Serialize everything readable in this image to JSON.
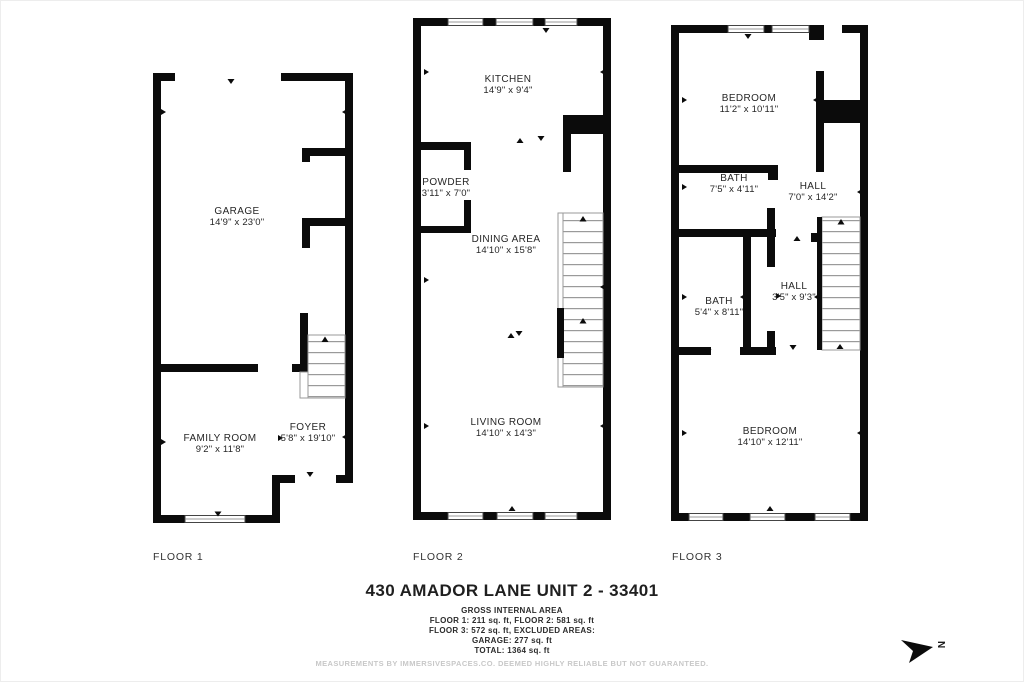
{
  "building": {
    "title": "430 AMADOR LANE UNIT 2 - 33401"
  },
  "area_summary": {
    "heading": "GROSS INTERNAL AREA",
    "lines": [
      "FLOOR 1: 211 sq. ft, FLOOR 2: 581 sq. ft",
      "FLOOR 3: 572 sq. ft, EXCLUDED AREAS:",
      "GARAGE: 277 sq. ft",
      "TOTAL: 1364 sq. ft"
    ],
    "disclaimer": "MEASUREMENTS BY IMMERSIVESPACES.CO. DEEMED HIGHLY RELIABLE BUT NOT GUARANTEED."
  },
  "compass": {
    "label": "N"
  },
  "floors": [
    {
      "label": "FLOOR 1",
      "rooms": [
        {
          "name": "GARAGE",
          "dims": "14'9\" x 23'0\""
        },
        {
          "name": "FAMILY ROOM",
          "dims": "9'2\" x 11'8\""
        },
        {
          "name": "FOYER",
          "dims": "5'8\" x 19'10\""
        }
      ]
    },
    {
      "label": "FLOOR 2",
      "rooms": [
        {
          "name": "KITCHEN",
          "dims": "14'9\" x 9'4\""
        },
        {
          "name": "POWDER",
          "dims": "3'11\" x 7'0\""
        },
        {
          "name": "DINING AREA",
          "dims": "14'10\" x 15'8\""
        },
        {
          "name": "LIVING ROOM",
          "dims": "14'10\" x 14'3\""
        }
      ]
    },
    {
      "label": "FLOOR 3",
      "rooms": [
        {
          "name": "BEDROOM",
          "dims": "11'2\" x 10'11\""
        },
        {
          "name": "BATH",
          "dims": "7'5\" x 4'11\""
        },
        {
          "name": "HALL",
          "dims": "7'0\" x 14'2\""
        },
        {
          "name": "BATH",
          "dims": "5'4\" x 8'11\""
        },
        {
          "name": "HALL",
          "dims": "3'5\" x 9'3\""
        },
        {
          "name": "BEDROOM",
          "dims": "14'10\" x 12'11\""
        }
      ]
    }
  ]
}
